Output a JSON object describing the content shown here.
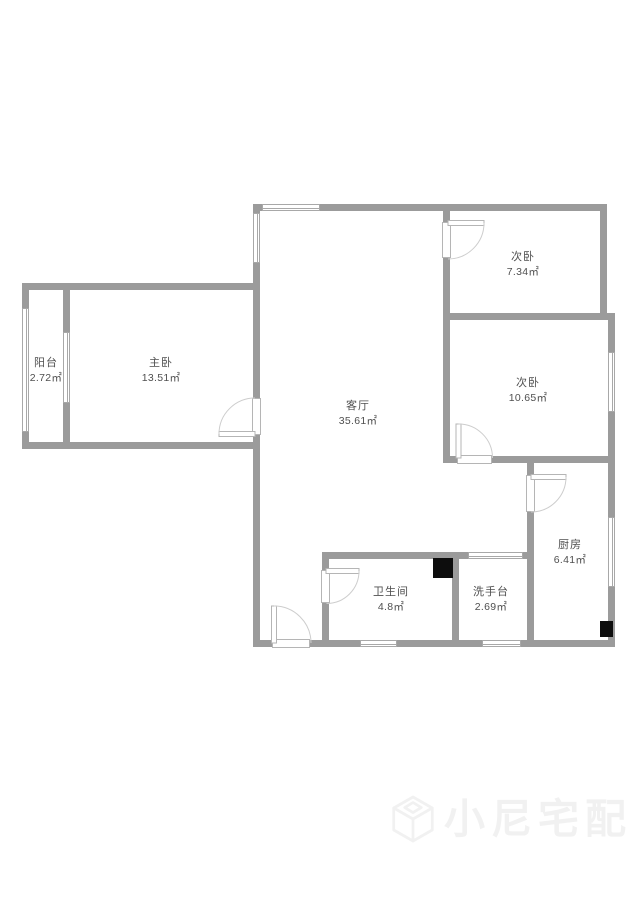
{
  "plan": {
    "rooms": [
      {
        "id": "balcony",
        "name": "阳台",
        "area": "2.72㎡"
      },
      {
        "id": "master-bedroom",
        "name": "主卧",
        "area": "13.51㎡"
      },
      {
        "id": "living-room",
        "name": "客厅",
        "area": "35.61㎡"
      },
      {
        "id": "bedroom-a",
        "name": "次卧",
        "area": "7.34㎡"
      },
      {
        "id": "bedroom-b",
        "name": "次卧",
        "area": "10.65㎡"
      },
      {
        "id": "kitchen",
        "name": "厨房",
        "area": "6.41㎡"
      },
      {
        "id": "bathroom",
        "name": "卫生间",
        "area": "4.8㎡"
      },
      {
        "id": "washstand",
        "name": "洗手台",
        "area": "2.69㎡"
      }
    ],
    "watermark": {
      "brand": "小尼宅配",
      "logo": "cube-logo"
    },
    "colors": {
      "wall": "#9b9b9b",
      "window_line": "#a8a8a8",
      "door_line": "#cdcdcd",
      "leaf_line": "#b5b5b5",
      "label_text": "#4f4f4f",
      "fixture": "#0d0d0d",
      "watermark": "#f1f1f1"
    }
  }
}
